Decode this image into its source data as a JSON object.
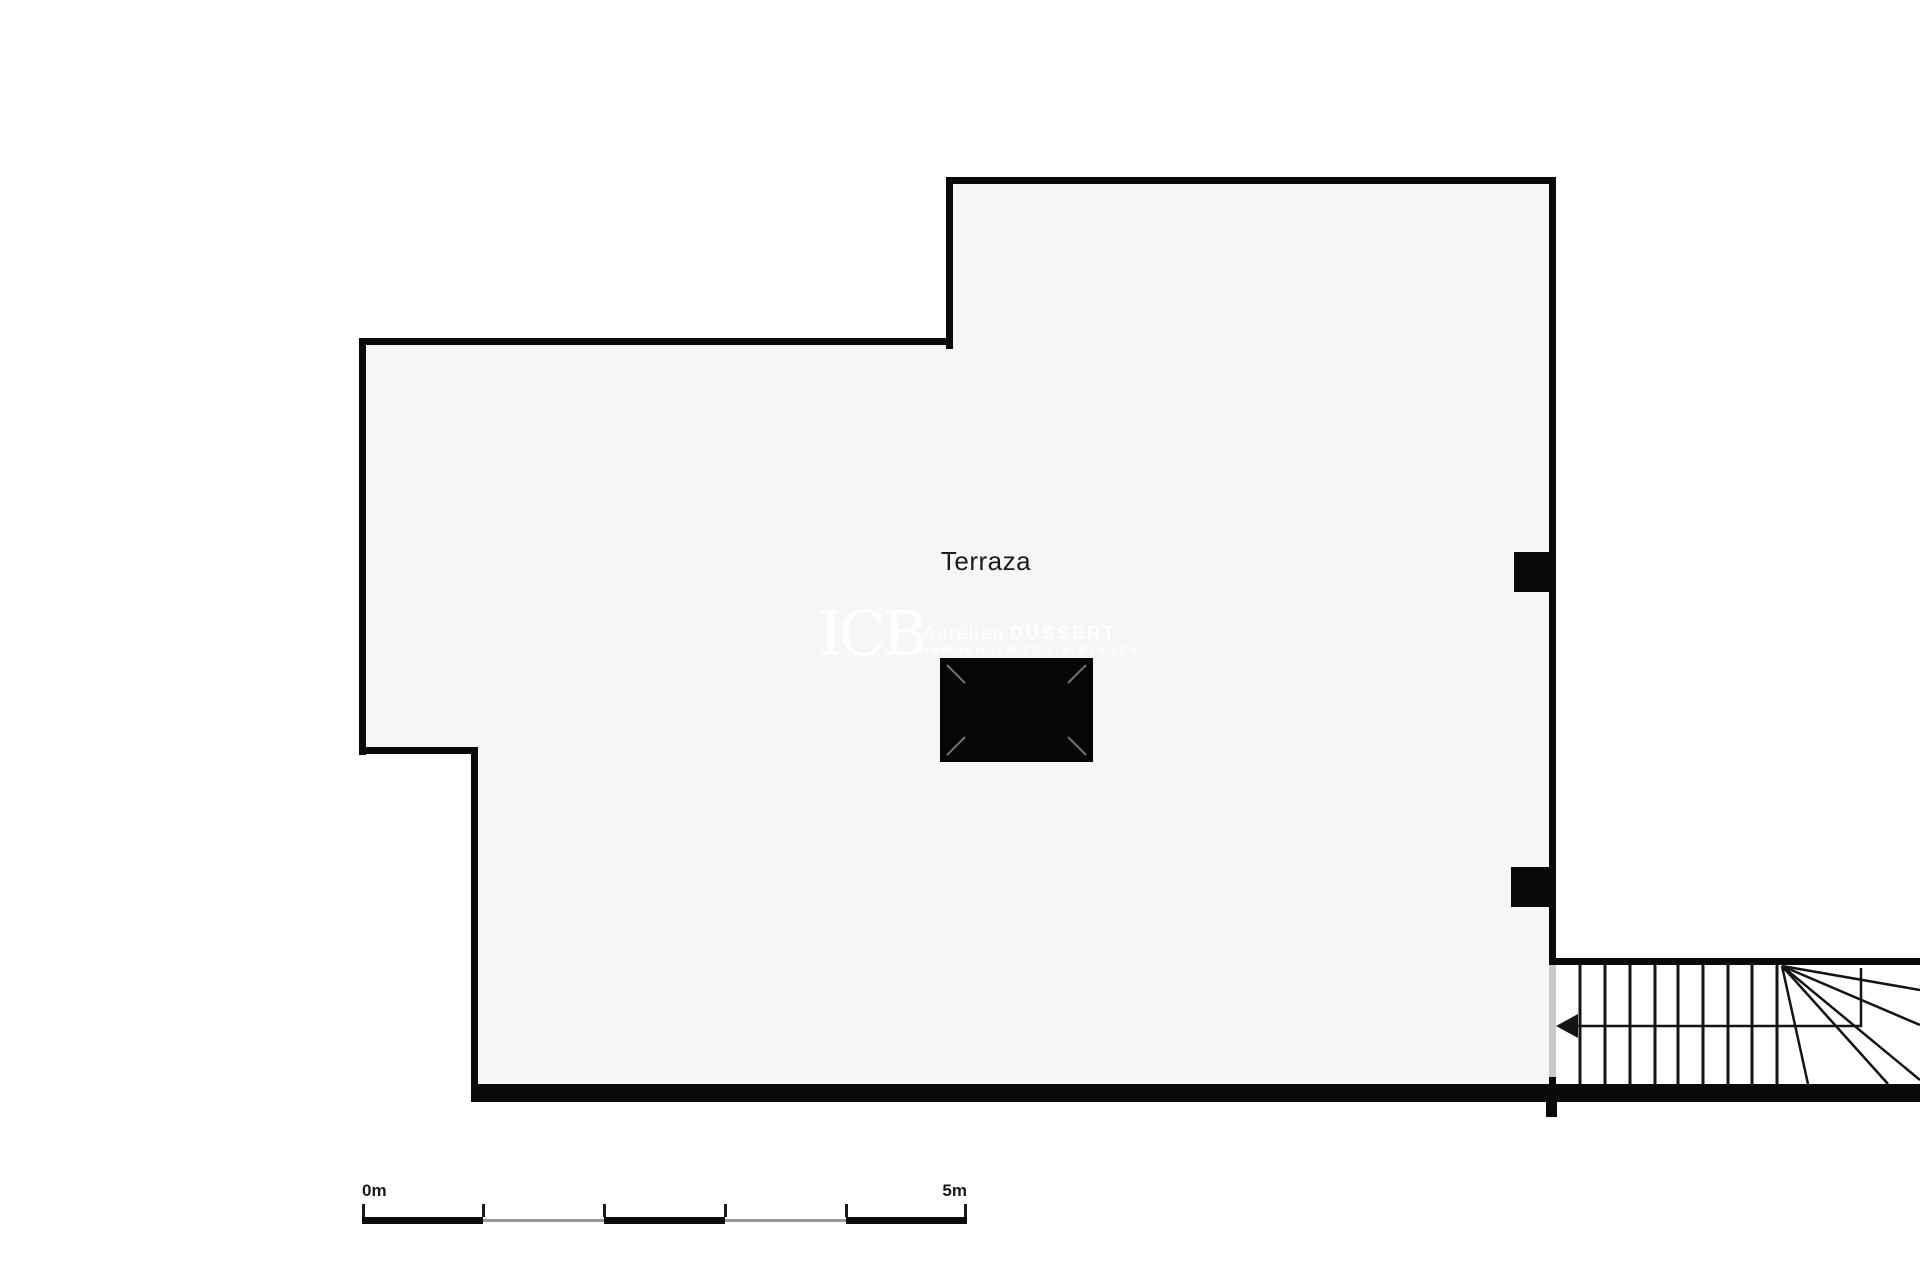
{
  "floorplan": {
    "room_label": "Terraza",
    "watermark": {
      "logo": "ICB",
      "agent_first_name": "Aurélien",
      "agent_last_name": "DUSSERT",
      "subtitle": "IMMOBILIER COSTA BLANCA"
    },
    "scale_bar": {
      "start_label": "0m",
      "end_label": "5m",
      "total_meters": 5,
      "segments": 5
    },
    "colors": {
      "wall": "#0a0a0a",
      "interior_fill": "#f6f6f6",
      "background": "#ffffff",
      "door_opening": "#c9c9c9",
      "scale_gray": "#9b9b9b",
      "label_text": "#1b1b1b"
    }
  }
}
